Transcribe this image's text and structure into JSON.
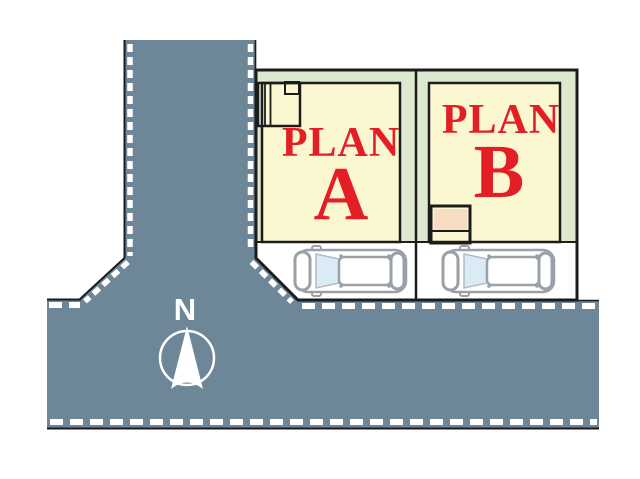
{
  "title": "Site plan with two lots",
  "colors": {
    "road": "#6d8698",
    "band": "#dde8ce",
    "plot": "#fbf7d1",
    "entrance": "#f6dcc3",
    "accent_red": "#e41e25",
    "line": "#1c1c1c",
    "car_gray": "#99a0a8",
    "glass": "#d9ecf6",
    "dash_white": "#ffffff"
  },
  "plots": [
    {
      "word": "PLAN",
      "letter": "A"
    },
    {
      "word": "PLAN",
      "letter": "B"
    }
  ],
  "compass": {
    "north_label": "N"
  }
}
